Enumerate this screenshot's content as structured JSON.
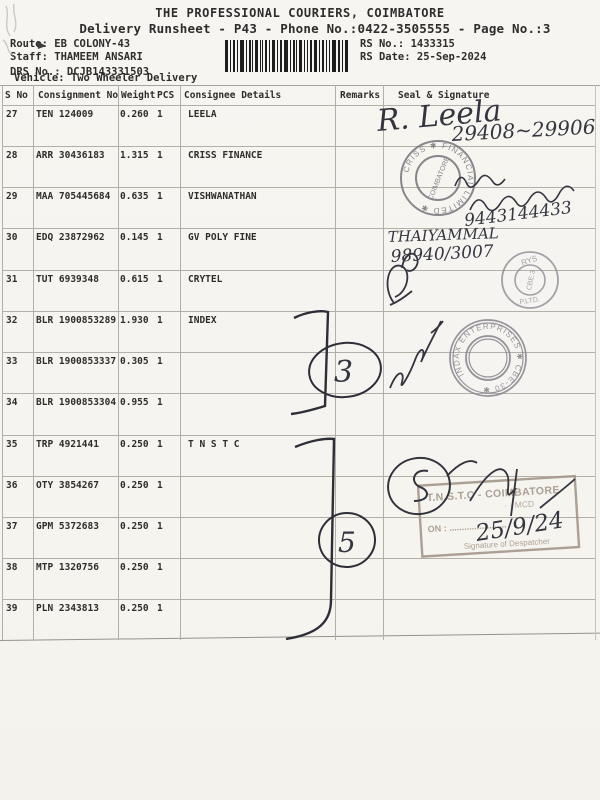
{
  "page": {
    "title": "THE PROFESSIONAL COURIERS, COIMBATORE",
    "subtitle": "Delivery Runsheet - P43 - Phone No.:0422-3505555 - Page No.:3",
    "route_label": "Route:",
    "route_value": "EB COLONY-43",
    "staff_label": "Staff:",
    "staff_value": "THAMEEM ANSARI",
    "drs_label": "DRS No.:",
    "drs_value": "DCJB143331503",
    "vehicle_label": "Vehicle:",
    "vehicle_value": "Two Wheeler Delivery",
    "rs_no_label": "RS No.:",
    "rs_no_value": "1433315",
    "rs_date_label": "RS Date:",
    "rs_date_value": "25-Sep-2024"
  },
  "table": {
    "headers": {
      "sno": "S No",
      "consignment": "Consignment No",
      "weight": "Weight",
      "pcs": "PCS",
      "consignee": "Consignee Details",
      "remarks": "Remarks",
      "seal": "Seal & Signature"
    },
    "rows": [
      {
        "sno": "27",
        "consignment": "TEN 124009",
        "weight": "0.260",
        "pcs": "1",
        "consignee": "LEELA"
      },
      {
        "sno": "28",
        "consignment": "ARR 30436183",
        "weight": "1.315",
        "pcs": "1",
        "consignee": "CRISS FINANCE"
      },
      {
        "sno": "29",
        "consignment": "MAA 705445684",
        "weight": "0.635",
        "pcs": "1",
        "consignee": "VISHWANATHAN"
      },
      {
        "sno": "30",
        "consignment": "EDQ 23872962",
        "weight": "0.145",
        "pcs": "1",
        "consignee": "GV POLY FINE"
      },
      {
        "sno": "31",
        "consignment": "TUT 6939348",
        "weight": "0.615",
        "pcs": "1",
        "consignee": "CRYTEL"
      },
      {
        "sno": "32",
        "consignment": "BLR 1900853289",
        "weight": "1.930",
        "pcs": "1",
        "consignee": "INDEX"
      },
      {
        "sno": "33",
        "consignment": "BLR 1900853337",
        "weight": "0.305",
        "pcs": "1",
        "consignee": ""
      },
      {
        "sno": "34",
        "consignment": "BLR 1900853304",
        "weight": "0.955",
        "pcs": "1",
        "consignee": ""
      },
      {
        "sno": "35",
        "consignment": "TRP 4921441",
        "weight": "0.250",
        "pcs": "1",
        "consignee": "T N S T C"
      },
      {
        "sno": "36",
        "consignment": "OTY 3854267",
        "weight": "0.250",
        "pcs": "1",
        "consignee": ""
      },
      {
        "sno": "37",
        "consignment": "GPM 5372683",
        "weight": "0.250",
        "pcs": "1",
        "consignee": ""
      },
      {
        "sno": "38",
        "consignment": "MTP 1320756",
        "weight": "0.250",
        "pcs": "1",
        "consignee": ""
      },
      {
        "sno": "39",
        "consignment": "PLN 2343813",
        "weight": "0.250",
        "pcs": "1",
        "consignee": ""
      }
    ]
  },
  "remarks_column": {
    "group1_count": "3",
    "group2_count": "5"
  },
  "seal_column": {
    "sig27_name": "R. Leela",
    "sig27_number": "29408~29906",
    "stamp_criss_ring": "CRISS ✱ FINANCIAL LIMITED ✱",
    "stamp_criss_inner": "COIMBATORE",
    "sig28_number": "9443144433",
    "hw30_name": "THAIYAMMAL",
    "hw30_number": "98940/3007",
    "stamp_rys_top": "RYS",
    "stamp_rys_bottom": ".P.LTD.",
    "stamp_rys_inner": "CBE:3",
    "stamp_indax_ring": "INDAX ENTERPRISES ✱ CBE-30 ✱",
    "stamp_tnstc_line1": "T.N.S.T.C - COIMBATORE",
    "stamp_tnstc_line2": "· ·  MCD",
    "stamp_tnstc_on": "ON : .......................",
    "stamp_tnstc_sign": "Signature of Despatcher",
    "hw35_date": "25/9/24"
  }
}
